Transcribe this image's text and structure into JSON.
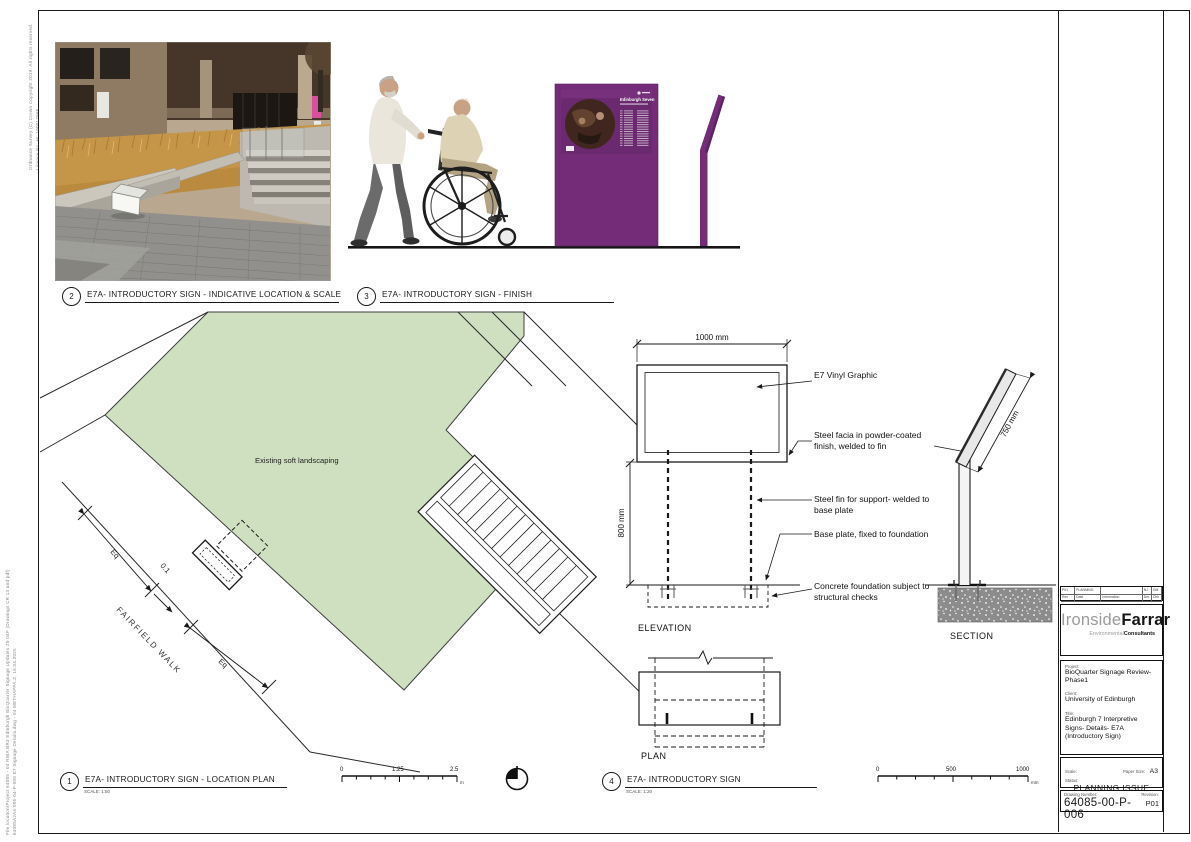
{
  "edge_notes": {
    "copyright_vertical": "Ordnance Survey (C) Crown Copyright 2019. All rights reserved. Licence No. HL 100017966",
    "plot_stamp_vertical": "File location\\Project 64085 - 04 RIBA BR3 Edinburgh BioQuarter Signage Updates 20 04P (Drawings CR 13 and pdf) 64085A2A4-005-04-P-006 E7 Signage Details.dwg - 04 METHAFPA.Z, 16.04.2025"
  },
  "drawing2": {
    "number": "2",
    "title": "E7A- INTRODUCTORY SIGN - INDICATIVE LOCATION & SCALE"
  },
  "drawing3": {
    "number": "3",
    "title": "E7A- INTRODUCTORY SIGN - FINISH",
    "sign_heading": "Edinburgh Seven"
  },
  "drawing1": {
    "number": "1",
    "title": "E7A- INTRODUCTORY SIGN - LOCATION PLAN",
    "scale_note": "SCALE: 1:50",
    "labels": {
      "landscaping": "Existing soft landscaping",
      "street": "FAIRFIELD WALK",
      "eq_upper": "Eq",
      "eq_lower": "Eq",
      "offset": "0.1"
    }
  },
  "drawing4": {
    "number": "4",
    "title": "E7A- INTRODUCTORY SIGN",
    "scale_note": "SCALE: 1:20",
    "dims": {
      "width": "1000 mm",
      "height": "800 mm",
      "panel_length": "750 mm"
    },
    "annotations": {
      "vinyl": "E7 Vinyl Graphic",
      "facia": "Steel facia in powder-coated finish, welded to fin",
      "fin": "Steel fin for support- welded to base plate",
      "base": "Base plate, fixed to foundation",
      "foundation": "Concrete foundation subject to structural checks"
    },
    "views": {
      "elevation": "ELEVATION",
      "section": "SECTION",
      "plan": "PLAN"
    }
  },
  "scale_bars": {
    "metres": {
      "zero": "0",
      "mid": "1.25",
      "end": "2.5",
      "unit": "m"
    },
    "millimetres": {
      "zero": "0",
      "mid": "500",
      "end": "1000",
      "unit": "mm"
    }
  },
  "title_block": {
    "revision_table": {
      "r1c1": "P01",
      "r1c2": "PLANNING",
      "r1c3": "",
      "r1c4": "NJ",
      "r1c5": "GM",
      "r2c1": "Rev",
      "r2c2": "Date",
      "r2c3": "Information",
      "r2c4": "Drn",
      "r2c5": "Chk"
    },
    "logo": {
      "name_light": "Ironside",
      "name_bold": "Farrar",
      "sub_light": "Environmental",
      "sub_bold": "Consultants"
    },
    "project_label": "Project:",
    "project": "BioQuarter Signage Review- Phase1",
    "client_label": "Client:",
    "client": "University of Edinburgh",
    "title_label": "Title:",
    "title": "Edinburgh 7 Interpretive Signs- Details- E7A (Introductory Sign)",
    "scale_label": "Scale:",
    "paper_label": "Paper Size:",
    "paper_size": "A3",
    "status_label": "Status:",
    "status": "PLANNING ISSUE",
    "stage": "RIBA STAGE 3",
    "number_label": "Drawing Number:",
    "drawing_number": "64085-00-P-006",
    "revision_label": "Revision:",
    "revision": "P01"
  }
}
